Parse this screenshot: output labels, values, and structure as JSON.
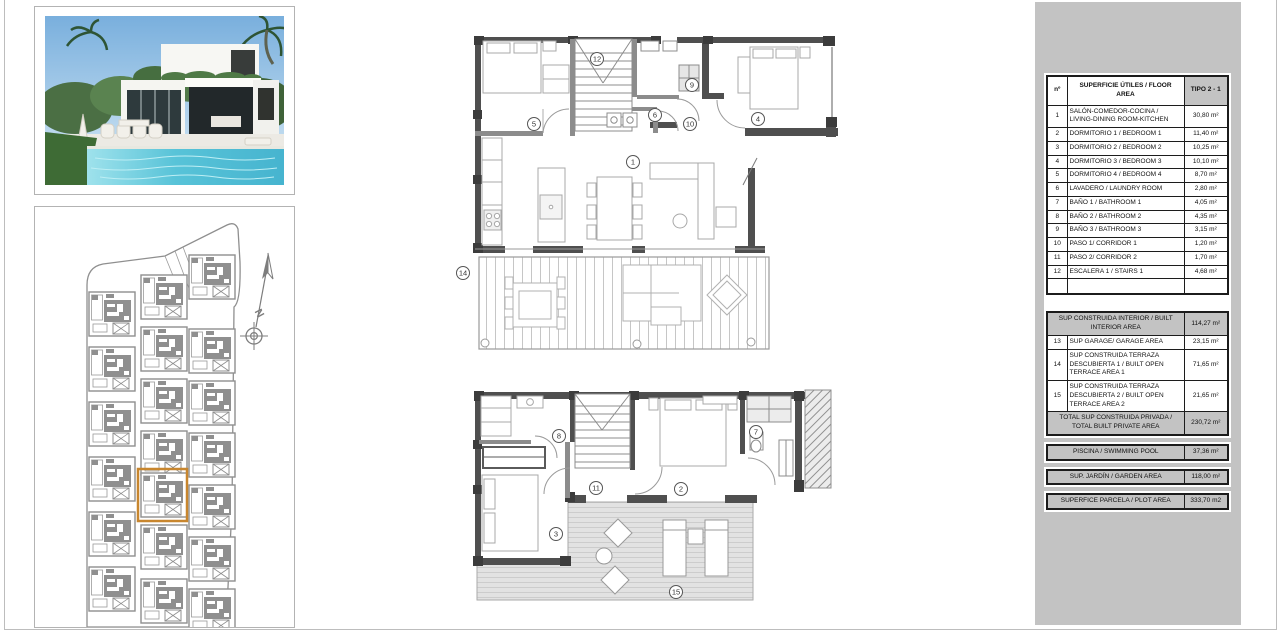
{
  "area_table": {
    "headers": {
      "num": "nº",
      "desc": "SUPERFICIE ÚTILES / FLOOR AREA",
      "type": "TIPO 2 - 1"
    },
    "rows": [
      {
        "num": "1",
        "label": "SALÓN-COMEDOR-COCINA / LIVING-DINING ROOM-KITCHEN",
        "value": "30,80 m²"
      },
      {
        "num": "2",
        "label": "DORMITORIO 1 / BEDROOM 1",
        "value": "11,40 m²"
      },
      {
        "num": "3",
        "label": "DORMITORIO 2 / BEDROOM 2",
        "value": "10,25 m²"
      },
      {
        "num": "4",
        "label": "DORMITORIO 3 / BEDROOM 3",
        "value": "10,10 m²"
      },
      {
        "num": "5",
        "label": "DORMITORIO 4 / BEDROOM 4",
        "value": "8,70 m²"
      },
      {
        "num": "6",
        "label": "LAVADERO / LAUNDRY ROOM",
        "value": "2,80 m²"
      },
      {
        "num": "7",
        "label": "BAÑO 1 / BATHROOM 1",
        "value": "4,05 m²"
      },
      {
        "num": "8",
        "label": "BAÑO 2 / BATHROOM 2",
        "value": "4,35 m²"
      },
      {
        "num": "9",
        "label": "BAÑO 3 / BATHROOM 3",
        "value": "3,15 m²"
      },
      {
        "num": "10",
        "label": "PASO 1/ CORRIDOR 1",
        "value": "1,20 m²"
      },
      {
        "num": "11",
        "label": "PASO 2/ CORRIDOR 2",
        "value": "1,70 m²"
      },
      {
        "num": "12",
        "label": "ESCALERA 1 / STAIRS 1",
        "value": "4,68 m²"
      }
    ],
    "built_rows": [
      {
        "num": "",
        "label": "SUP CONSTRUIDA INTERIOR / BUILT INTERIOR AREA",
        "value": "114,27 m²",
        "gray": true,
        "span": true
      },
      {
        "num": "13",
        "label": "SUP GARAGE/ GARAGE AREA",
        "value": "23,15 m²"
      },
      {
        "num": "14",
        "label": "SUP CONSTRUIDA TERRAZA DESCUBIERTA 1 / BUILT OPEN TERRACE AREA 1",
        "value": "71,65 m²"
      },
      {
        "num": "15",
        "label": "SUP CONSTRUIDA TERRAZA DESCUBIERTA 2 / BUILT OPEN TERRACE AREA 2",
        "value": "21,65 m²"
      },
      {
        "num": "",
        "label": "TOTAL SUP CONSTRUIDA PRIVADA / TOTAL BUILT PRIVATE AREA",
        "value": "230,72 m²",
        "gray": true,
        "span": true
      }
    ],
    "footer_rows": [
      {
        "label": "PISCINA / SWIMMING POOL",
        "value": "37,36 m²"
      },
      {
        "label": "SUP. JARDÍN / GARDEN AREA",
        "value": "118,00 m²"
      },
      {
        "label": "SUPERFICE PARCELA / PLOT AREA",
        "value": "333,70 m2"
      }
    ]
  },
  "plans": {
    "upper_labels": [
      "12",
      "9",
      "5",
      "6",
      "10",
      "4",
      "1",
      "14"
    ],
    "lower_labels": [
      "8",
      "7",
      "2",
      "11",
      "3",
      "15"
    ]
  },
  "site_plan": {
    "north_label": "N",
    "highlight_color": "#c8862e"
  },
  "colors": {
    "panel": "#c3c3c3",
    "wall_dark": "#4f4f4f",
    "wall_light": "#8c8c8c",
    "highlight": "#c8862e"
  }
}
